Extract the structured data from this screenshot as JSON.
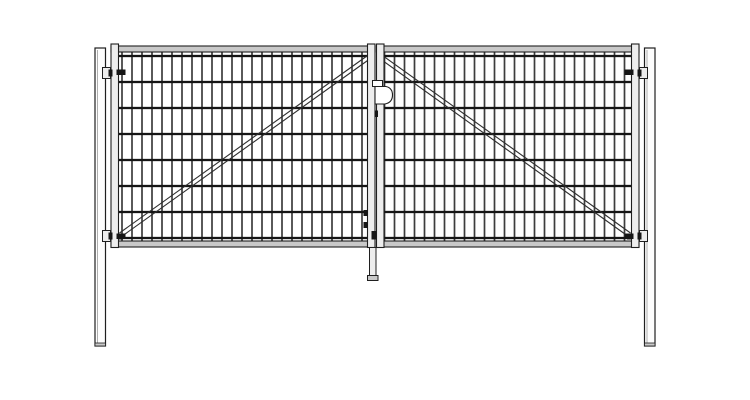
{
  "meta": {
    "subject": "double-leaf-mesh-gate-front-elevation",
    "canvas": {
      "width": 750,
      "height": 400
    },
    "background": "#ffffff"
  },
  "colors": {
    "background": "#ffffff",
    "line": "#1f1f1f",
    "wire_vertical": "#3d3d3d",
    "wire_horizontal": "#151515",
    "rail_fill": "#c9c9c9",
    "stile_fill": "#ededed",
    "post_fill": "#fdfdfd",
    "post_inner": "#9a9a9a",
    "brace": "#2e2e2e",
    "dark": "#161616",
    "lock_fill": "#ffffff"
  },
  "drawing": {
    "posts": {
      "left": {
        "x": 95,
        "y": 48,
        "w": 10.5,
        "h": 298
      },
      "right": {
        "x": 644.5,
        "y": 48,
        "w": 10.5,
        "h": 298
      }
    },
    "mesh_spec": {
      "vertical_spacing": 10,
      "vertical_wire_w": 1.7,
      "horizontal_wire_h": 2.3,
      "horizontal_ys": [
        56,
        82,
        108,
        134,
        160,
        186,
        212,
        238
      ]
    },
    "leaves": {
      "left": {
        "frame": {
          "x1": 111,
          "x2": 375,
          "top": 44,
          "bottom": 247.5,
          "stile_w": 7.5,
          "rail_top_y": 46,
          "rail_bottom_y": 241,
          "rail_h": 6
        },
        "mesh": {
          "x1": 118.5,
          "x2": 367.5,
          "y1": 52,
          "y2": 241,
          "wire_x0": 122,
          "wire_x1": 363
        },
        "brace": {
          "x1": 119.5,
          "y1": 233,
          "x2": 369,
          "y2": 54.5,
          "gap": 5,
          "anchor": {
            "x": 114.5,
            "y": 233.5,
            "w": 8.5,
            "h": 6
          }
        }
      },
      "right": {
        "frame": {
          "x1": 376.5,
          "x2": 639,
          "top": 44,
          "bottom": 247.5,
          "stile_w": 7.5,
          "rail_top_y": 46,
          "rail_bottom_y": 241,
          "rail_h": 6
        },
        "mesh": {
          "x1": 384,
          "x2": 631.5,
          "y1": 52,
          "y2": 241,
          "wire_x0": 384.5,
          "wire_x1": 625
        },
        "brace": {
          "x1": 381,
          "y1": 54.5,
          "x2": 630.5,
          "y2": 233,
          "gap": 5,
          "anchor": {
            "x": 627,
            "y": 233.5,
            "w": 8.5,
            "h": 6
          }
        }
      }
    },
    "hinge_spec": {
      "bracket": {
        "w": 8,
        "h": 11
      },
      "pin": {
        "w": 4,
        "h": 7
      },
      "bolt": {
        "w": 9,
        "h": 5.5
      }
    },
    "hinges": [
      {
        "id": "hinge-upper-left",
        "bracket": {
          "x": 102.5,
          "y": 67.5
        },
        "pin": {
          "x": 108.5,
          "y": 69.5
        },
        "bolt": {
          "x": 116.5,
          "y": 69.5
        }
      },
      {
        "id": "hinge-lower-left",
        "bracket": {
          "x": 102.5,
          "y": 230.5
        },
        "pin": {
          "x": 108.5,
          "y": 232.5
        },
        "bolt": {
          "x": 116.5,
          "y": 233.5
        }
      },
      {
        "id": "hinge-upper-right",
        "bracket": {
          "x": 639.5,
          "y": 67.5
        },
        "pin": {
          "x": 637.5,
          "y": 69.5
        },
        "bolt": {
          "x": 624.5,
          "y": 69.5
        }
      },
      {
        "id": "hinge-lower-right",
        "bracket": {
          "x": 639.5,
          "y": 230.5
        },
        "pin": {
          "x": 637.5,
          "y": 232.5
        },
        "bolt": {
          "x": 624.5,
          "y": 233.5
        }
      }
    ],
    "lock": {
      "tab": {
        "x": 372.5,
        "y": 80.5,
        "w": 10,
        "h": 6
      },
      "body_path": "M 375 86.5 L 386 86.5 Q 392.5 88 392.5 95 Q 392.5 102.5 385 104 L 375 104 Z",
      "bolt": {
        "x": 374.5,
        "y": 110.5,
        "w": 3.5,
        "h": 6.5
      }
    },
    "keeper_bolts": [
      {
        "x": 363.5,
        "y": 210,
        "w": 4.5,
        "h": 6
      },
      {
        "x": 363.5,
        "y": 222,
        "w": 4.5,
        "h": 6
      }
    ],
    "drop_rod": {
      "guide": {
        "x": 371.5,
        "y": 231,
        "w": 5,
        "h": 8.5
      },
      "rod": {
        "x": 369.5,
        "y": 247.5,
        "w": 6.5,
        "h": 28.5
      },
      "cap": {
        "x": 367.5,
        "y": 275.5,
        "w": 10.5,
        "h": 5
      }
    }
  }
}
